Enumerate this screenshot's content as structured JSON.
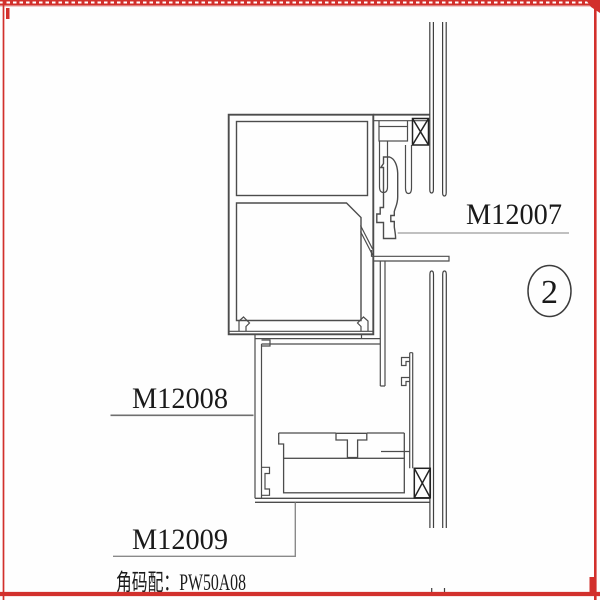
{
  "sheet": {
    "background": "#fefefe",
    "border_color": "#d2302c"
  },
  "labels": {
    "part_upper": "M12007",
    "part_middle": "M12008",
    "part_lower": "M12009"
  },
  "detail_bubble": {
    "number": "2"
  },
  "note": {
    "text": "角码配：PW50A08"
  },
  "colors": {
    "profile_line": "#4c4c4c",
    "hatch_line": "#222222",
    "leader_line": "#8a8a8a",
    "text": "#1a1a1a",
    "border_red": "#d2302c"
  }
}
